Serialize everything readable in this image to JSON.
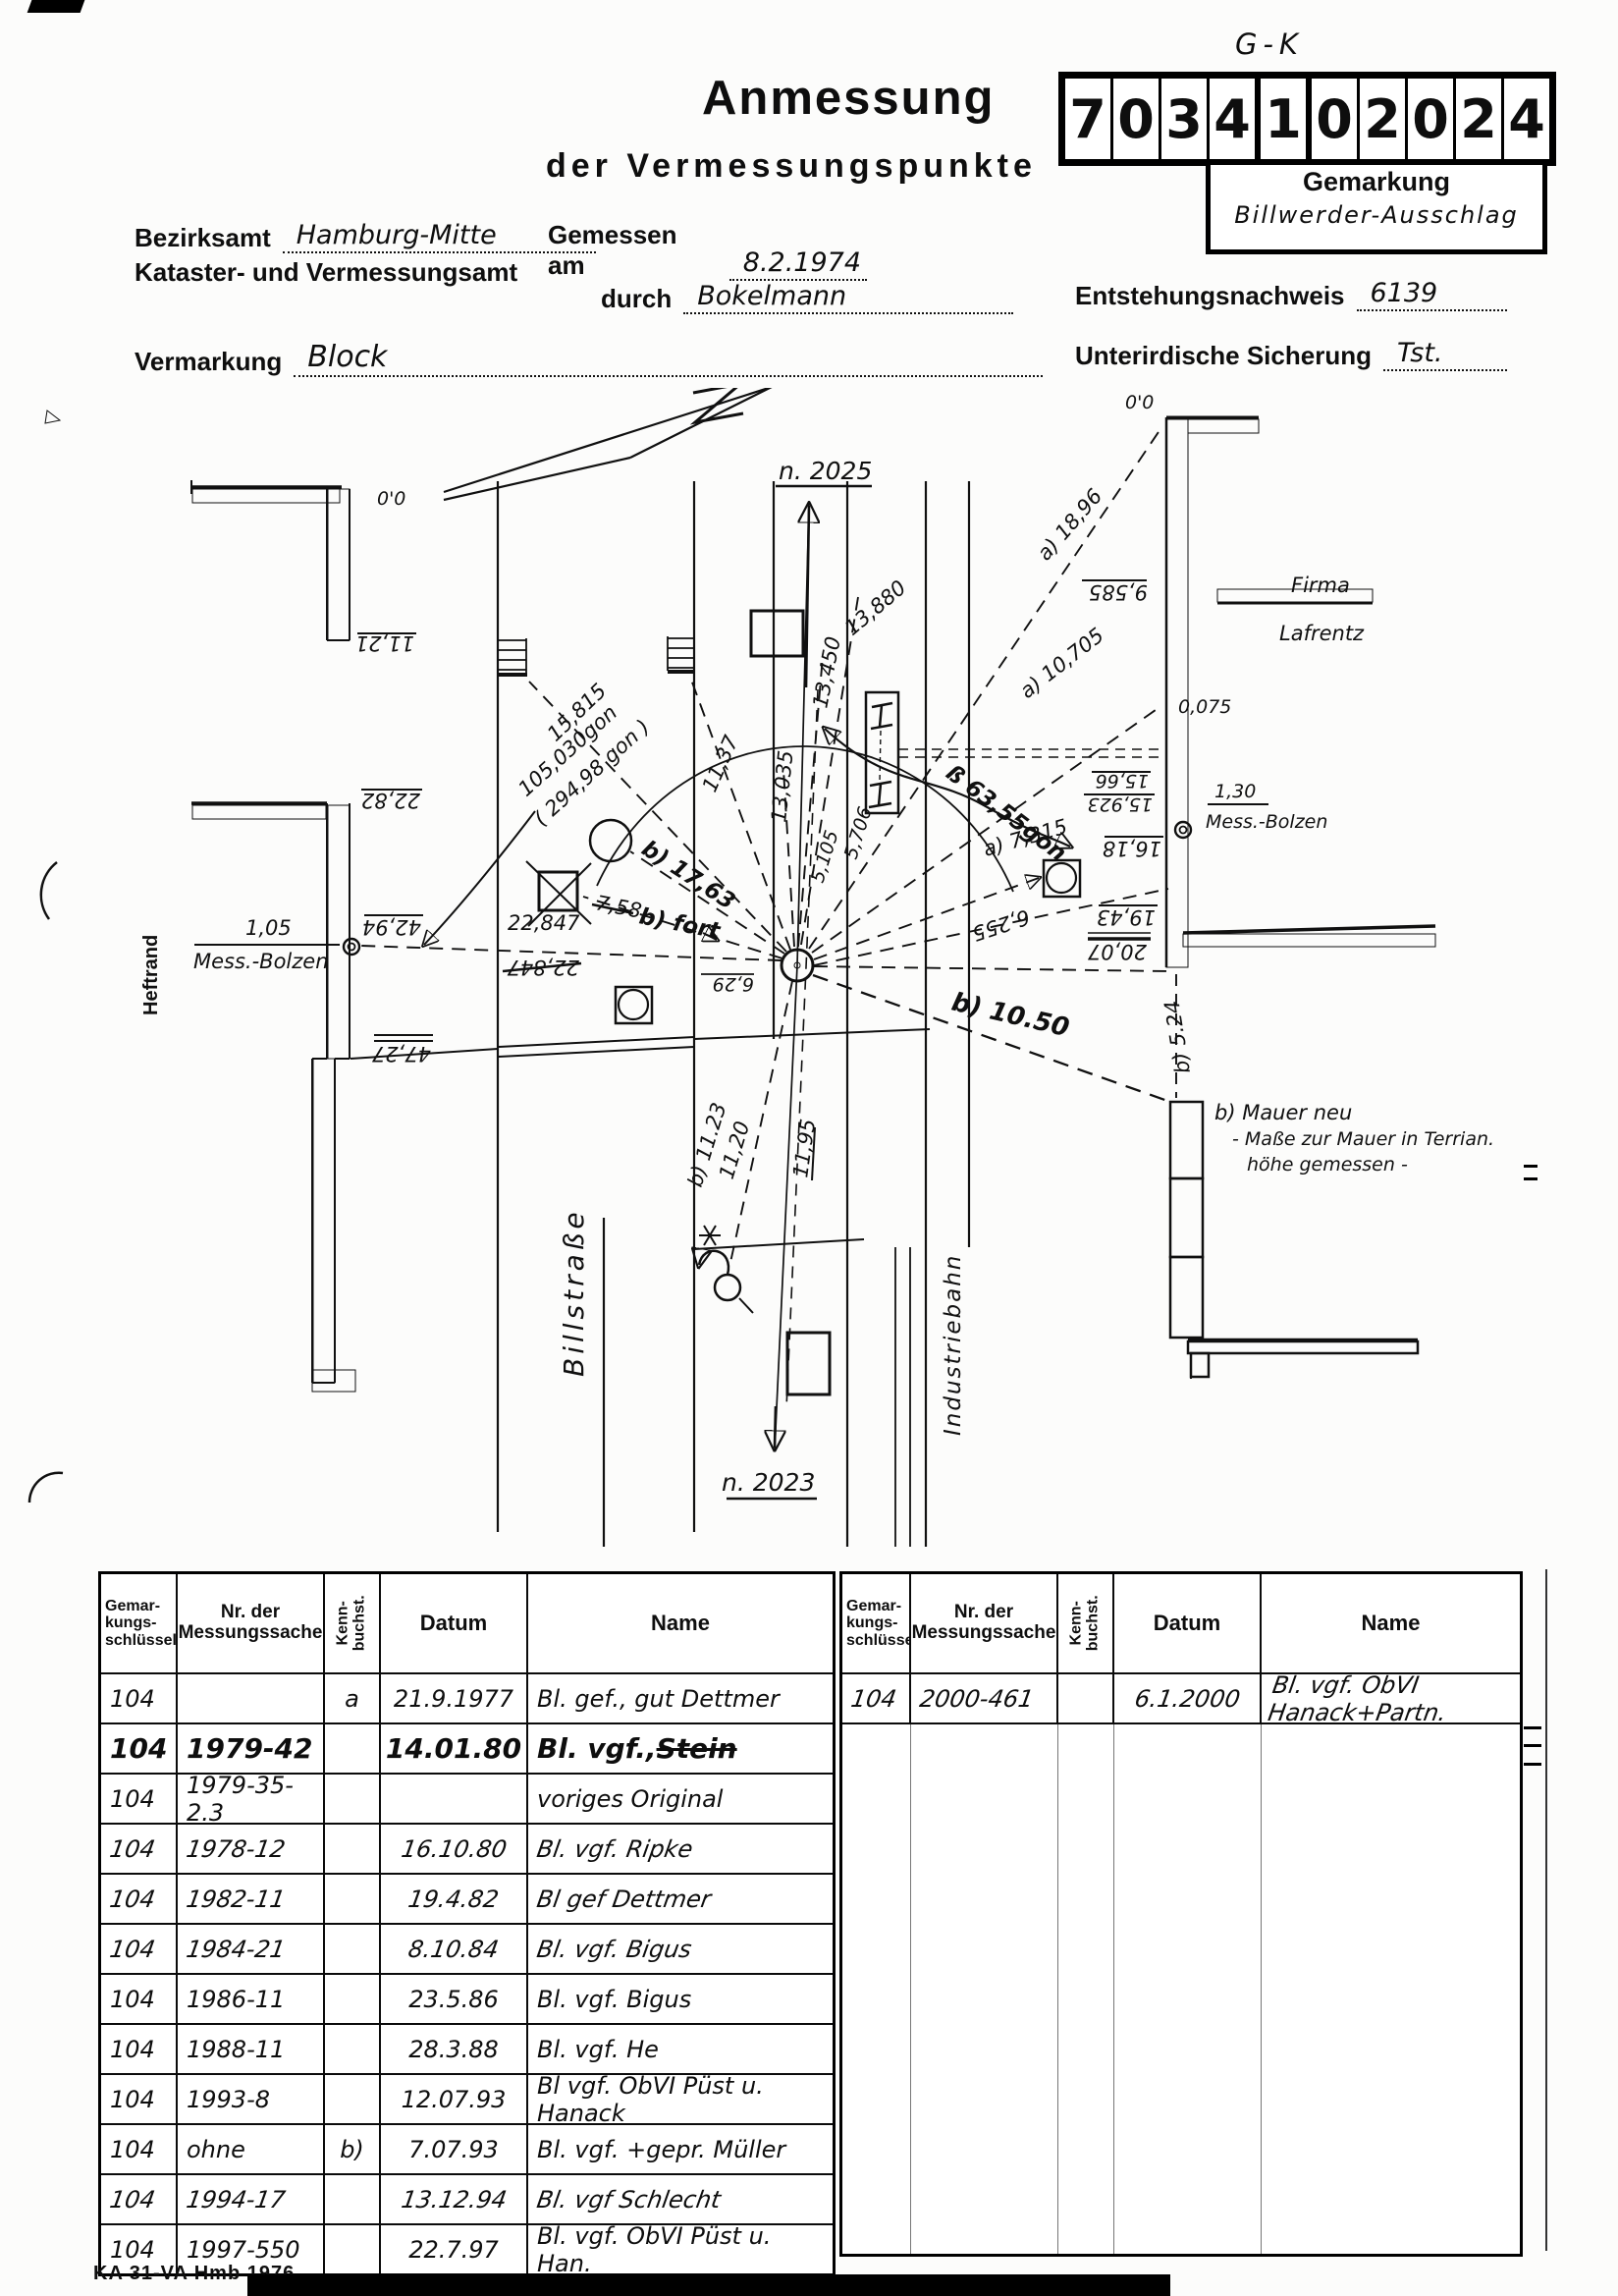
{
  "header": {
    "title_line1": "Anmessung",
    "title_line2": "der Vermessungspunkte",
    "gk_label": "G-K",
    "point_number": [
      "7",
      "0",
      "3",
      "4",
      "1",
      "0",
      "2",
      "0",
      "2",
      "4"
    ],
    "gemarkung_label": "Gemarkung",
    "gemarkung_value": "Billwerder-Ausschlag",
    "bezirksamt_label": "Bezirksamt",
    "bezirksamt_value": "Hamburg-Mitte",
    "amt_line": "Kataster- und Vermessungsamt",
    "gemessen_label": "Gemessen am",
    "gemessen_value": "8.2.1974",
    "durch_label": "durch",
    "durch_value": "Bokelmann",
    "entstehung_label": "Entstehungsnachweis",
    "entstehung_value": "6139",
    "vermarkung_label": "Vermarkung",
    "vermarkung_value": "Block",
    "sicherung_label": "Unterirdische Sicherung",
    "sicherung_value": "Tst."
  },
  "sketch": {
    "north_top": "n. 2025",
    "north_bottom": "n. 2023",
    "street_name": "Billstraße",
    "railway_name": "Industriebahn",
    "firm_name_1": "Firma",
    "firm_name_2": "Lafrentz",
    "margin_note": "Heftrand",
    "bolt_left_distance": "1,05",
    "bolt_left_name": "Mess.-Bolzen",
    "bolt_right_distance": "1,30",
    "bolt_right_name": "Mess.-Bolzen",
    "wall_note_line1": "b) Mauer neu",
    "wall_note_line2": "- Maße zur Mauer in Terrian.",
    "wall_note_line3": "höhe gemessen -",
    "chain_left_0": "0'0",
    "chain_left_1": "11,21",
    "chain_left_2": "22,82",
    "chain_left_3": "42,94",
    "chain_left_4": "47,27",
    "chain_right_0": "0'0",
    "chain_right_1": "9,585",
    "chain_right_2": "0,075",
    "chain_right_3": "15,66",
    "chain_right_4": "15,923",
    "chain_right_5": "16,18",
    "chain_right_6": "19,43",
    "chain_right_7": "20,07",
    "m_13880": "13,880",
    "m_13450": "13,450",
    "m_13035": "13,035",
    "m_15815": "15,815",
    "m_1137": "11,37",
    "m_a1896": "a) 18,96",
    "m_a10705": "a) 10,705",
    "m_a7315": "a) 7,315",
    "m_6255": "6,255",
    "m_5105": "5,105",
    "m_5706": "5,706",
    "m_b1763": "b) 17,63",
    "m_758": "7,58",
    "m_bfort": "b) fort",
    "m_22847": "22,847",
    "m_22847_old": "22,847",
    "m_gon1": "105,030gon",
    "m_gon2": "( 294,98 gon )",
    "m_gonb": "ß 63,55gon",
    "m_b1050": "b) 10.50",
    "m_b524": "b) 5.24",
    "m_b1123": "b) 11.23",
    "m_1120": "11,20",
    "m_1195": "11,95",
    "m_629": "6,29"
  },
  "table": {
    "col_key": [
      "Gemar-",
      "kungs-",
      "schlüssel"
    ],
    "col_nr": [
      "Nr. der",
      "Messungssache"
    ],
    "col_kenn": [
      "Kenn-",
      "buchst."
    ],
    "col_datum": "Datum",
    "col_name": "Name",
    "left_rows": [
      {
        "cells": [
          "104",
          "",
          "a",
          "21.9.1977",
          "Bl. gef., gut Dettmer"
        ],
        "pen": "n"
      },
      {
        "cells": [
          "104",
          "1979-42",
          "",
          "14.01.80",
          "Bl. vgf., Stein"
        ],
        "pen": "b",
        "strike_last": true
      },
      {
        "cells": [
          "104",
          "1979-35-2.3",
          "",
          "",
          "voriges Original"
        ],
        "pen": "n"
      },
      {
        "cells": [
          "104",
          "1978-12",
          "",
          "16.10.80",
          "Bl. vgf. Ripke"
        ],
        "pen": "s"
      },
      {
        "cells": [
          "104",
          "1982-11",
          "",
          "19.4.82",
          "Bl gef Dettmer"
        ],
        "pen": "s"
      },
      {
        "cells": [
          "104",
          "1984-21",
          "",
          "8.10.84",
          "Bl. vgf. Bigus"
        ],
        "pen": "s"
      },
      {
        "cells": [
          "104",
          "1986-11",
          "",
          "23.5.86",
          "Bl. vgf. Bigus"
        ],
        "pen": "n"
      },
      {
        "cells": [
          "104",
          "1988-11",
          "",
          "28.3.88",
          "Bl. vgf. He"
        ],
        "pen": "n"
      },
      {
        "cells": [
          "104",
          "1993-8",
          "",
          "12.07.93",
          "Bl vgf. ÖbVI Püst u. Hanack"
        ],
        "pen": "n"
      },
      {
        "cells": [
          "104",
          "ohne",
          "b)",
          "7.07.93",
          "Bl. vgf. +gepr. Müller"
        ],
        "pen": "n"
      },
      {
        "cells": [
          "104",
          "1994-17",
          "",
          "13.12.94",
          "Bl. vgf Schlecht"
        ],
        "pen": "s"
      },
      {
        "cells": [
          "104",
          "1997-550",
          "",
          "22.7.97",
          "Bl. vgf. ÖbVI Püst u. Han."
        ],
        "pen": "n"
      }
    ],
    "right_rows": [
      {
        "cells": [
          "104",
          "2000-461",
          "",
          "6.1.2000",
          "Bl. vgf. ÖbVI Hanack+Partn."
        ],
        "pen": "s"
      }
    ]
  },
  "footer": "KA 31-VA Hmb 1976"
}
